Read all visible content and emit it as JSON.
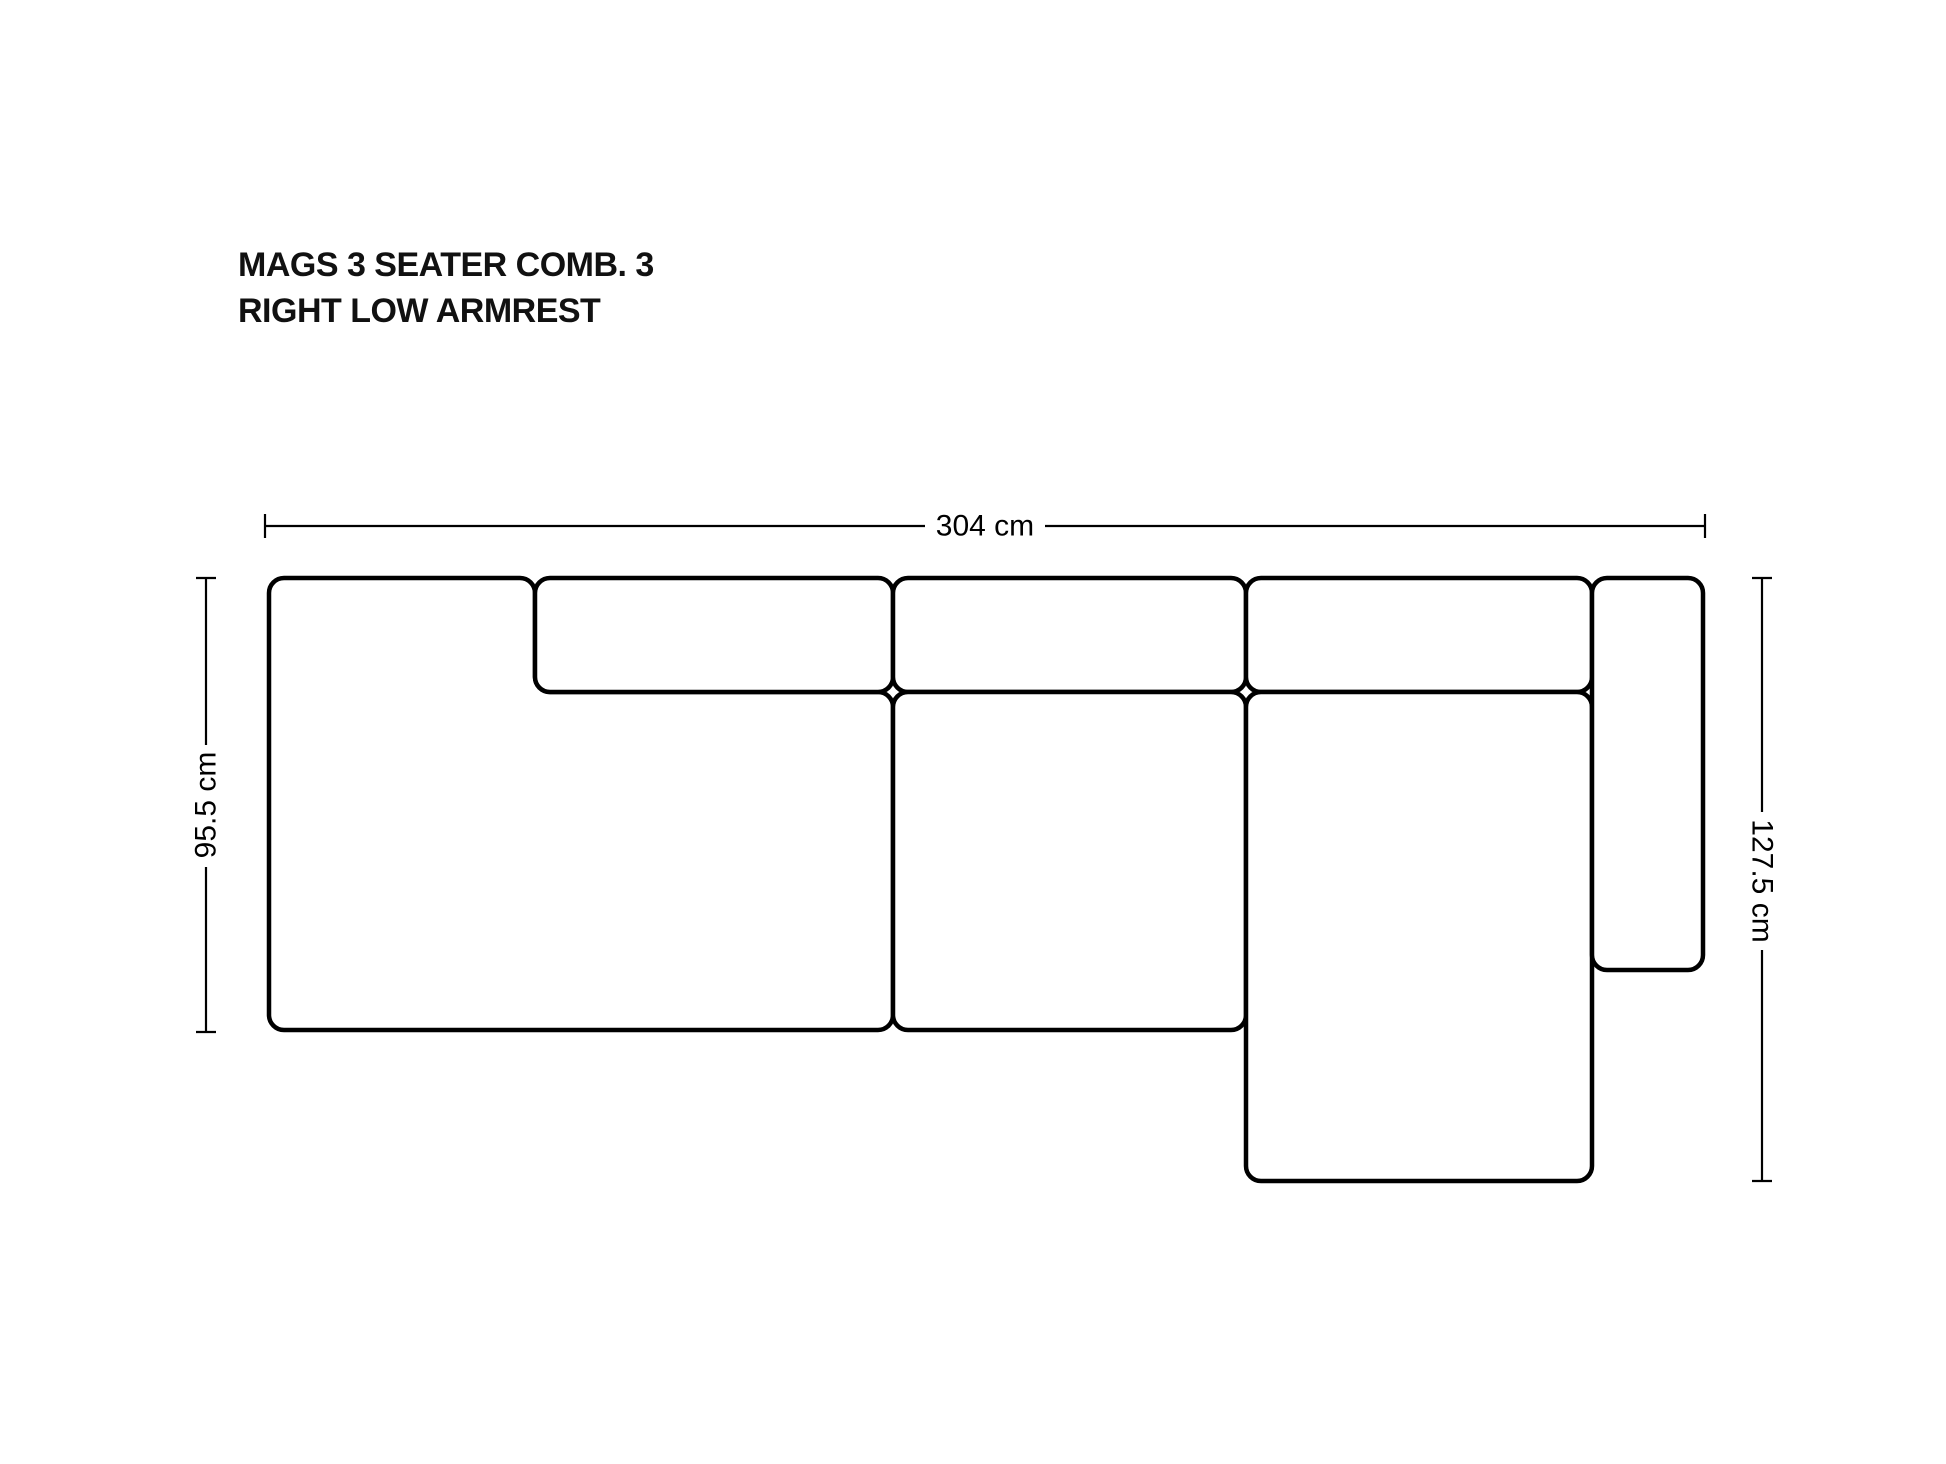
{
  "title": {
    "line1": "MAGS 3 SEATER COMB. 3",
    "line2": "RIGHT LOW ARMREST"
  },
  "dimensions": {
    "total_width": "304 cm",
    "left_depth": "95.5 cm",
    "right_depth": "127.5 cm"
  },
  "colors": {
    "background": "#ffffff",
    "line": "#000000",
    "title_text": "#111111"
  }
}
